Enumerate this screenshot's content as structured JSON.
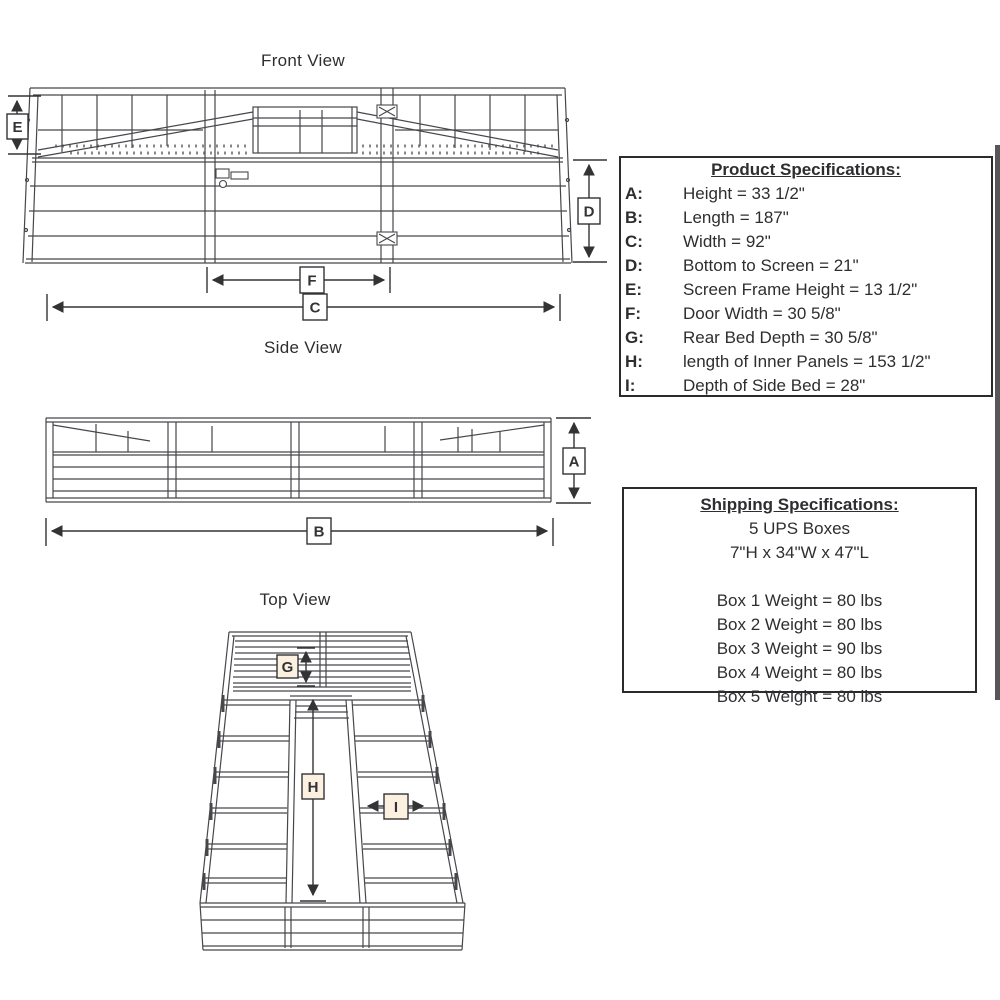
{
  "titles": {
    "front": "Front View",
    "side": "Side View",
    "top": "Top View"
  },
  "dim_labels": {
    "A": "A",
    "B": "B",
    "C": "C",
    "D": "D",
    "E": "E",
    "F": "F",
    "G": "G",
    "H": "H",
    "I": "I"
  },
  "product_specs": {
    "title": "Product Specifications:",
    "rows": [
      {
        "key": "A:",
        "value": "Height = 33 1/2\""
      },
      {
        "key": "B:",
        "value": "Length = 187\""
      },
      {
        "key": "C:",
        "value": "Width = 92\""
      },
      {
        "key": "D:",
        "value": "Bottom to Screen = 21\""
      },
      {
        "key": "E:",
        "value": "Screen Frame Height = 13 1/2\""
      },
      {
        "key": "F:",
        "value": "Door Width = 30 5/8\""
      },
      {
        "key": "G:",
        "value": "Rear Bed Depth = 30 5/8\""
      },
      {
        "key": "H:",
        "value": "length of Inner Panels = 153 1/2\""
      },
      {
        "key": "I:",
        "value": "Depth of Side Bed = 28\""
      }
    ]
  },
  "shipping_specs": {
    "title": "Shipping Specifications:",
    "summary": [
      "5 UPS Boxes",
      "7\"H x 34\"W x 47\"L"
    ],
    "weights": [
      "Box 1 Weight = 80 lbs",
      "Box 2 Weight = 80 lbs",
      "Box 3 Weight = 90 lbs",
      "Box 4 Weight = 80 lbs",
      "Box 5 Weight = 80 lbs"
    ]
  },
  "colors": {
    "line": "#47474b",
    "text": "#2e2e31",
    "warm_label_fill": "#fcf0e1"
  }
}
